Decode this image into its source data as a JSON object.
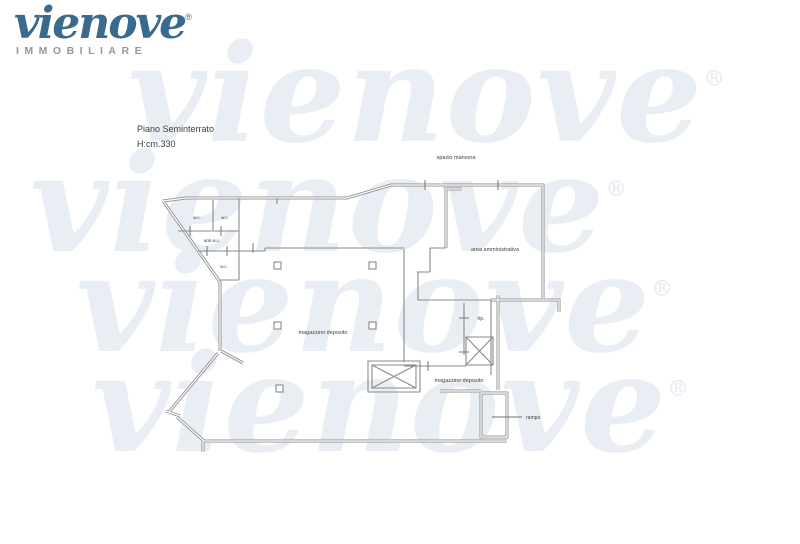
{
  "brand": {
    "logo_text": "vienove",
    "registered_mark": "®",
    "logo_subtext": "IMMOBILIARE",
    "logo_color": "#3a6a8d",
    "subtext_color": "#95989b"
  },
  "watermark": {
    "text": "vienove",
    "registered_mark": "®",
    "color": "#e9eef4"
  },
  "plan": {
    "title": "Piano Seminterrato",
    "height_note": "H:cm.330",
    "wall_color": "#919191",
    "inner_wall_color": "#8a8a8a",
    "label_color": "#3f3f3f",
    "labels": {
      "spazio_manovra": "spazio manovra",
      "area_amministrativa": "area amministrativa",
      "magazzino_deposito_main": "magazzino deposito",
      "magazzino_deposito_small": "magazzino deposito",
      "rip": "rip.",
      "rampa": "rampa",
      "wc_1": "w.c.",
      "wc_2": "w.c.",
      "anti_wc": "anti w.c.",
      "wc_3": "w.c."
    }
  }
}
